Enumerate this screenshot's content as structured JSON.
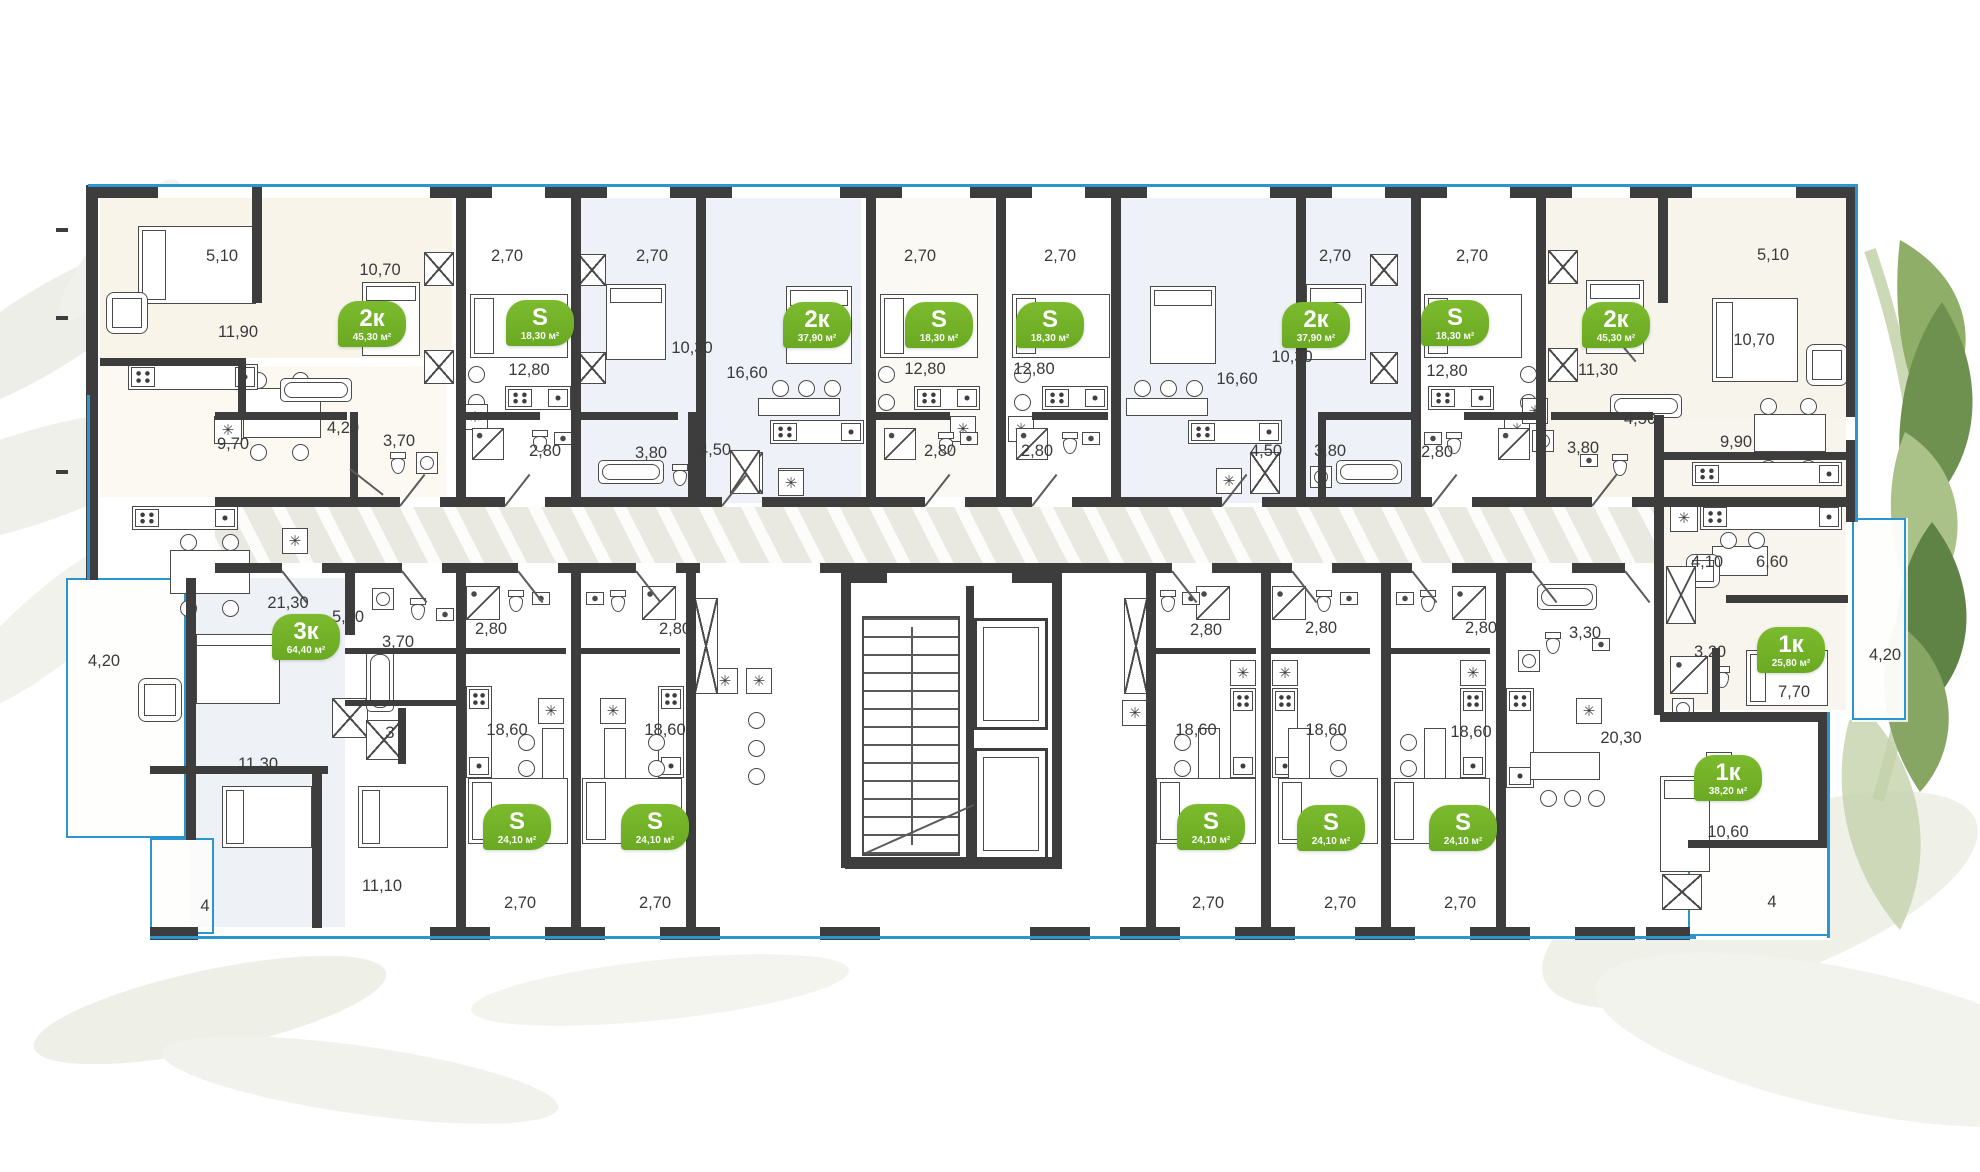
{
  "app": {
    "view": "residential-floor-plan"
  },
  "palette": {
    "wall": "#3d3d3d",
    "accent_green": "#74b228",
    "outline_blue": "#2a95d0",
    "corridor": "#e9e9e2",
    "room_cream": "#f8f4ea",
    "room_blue": "#eef1f7"
  },
  "units": [
    {
      "id": "u1",
      "type": "2к",
      "area": "45,30 м²",
      "badge": {
        "x": 372,
        "y": 324
      },
      "dims": [
        {
          "t": "5,10",
          "x": 222,
          "y": 256
        },
        {
          "t": "11,90",
          "x": 238,
          "y": 332
        },
        {
          "t": "10,70",
          "x": 380,
          "y": 270
        },
        {
          "t": "9,70",
          "x": 233,
          "y": 444
        },
        {
          "t": "4,20",
          "x": 343,
          "y": 428
        },
        {
          "t": "3,70",
          "x": 399,
          "y": 441
        }
      ]
    },
    {
      "id": "u2",
      "type": "S",
      "area": "18,30 м²",
      "badge": {
        "x": 540,
        "y": 323
      },
      "dims": [
        {
          "t": "2,70",
          "x": 507,
          "y": 256
        },
        {
          "t": "12,80",
          "x": 529,
          "y": 370
        },
        {
          "t": "2,80",
          "x": 545,
          "y": 451
        }
      ]
    },
    {
      "id": "u3",
      "type": "2к",
      "area": "37,90 м²",
      "badge": {
        "x": 817,
        "y": 325
      },
      "dims": [
        {
          "t": "2,70",
          "x": 652,
          "y": 256
        },
        {
          "t": "10,30",
          "x": 692,
          "y": 348
        },
        {
          "t": "16,60",
          "x": 747,
          "y": 373
        },
        {
          "t": "4,50",
          "x": 715,
          "y": 450
        },
        {
          "t": "3,80",
          "x": 651,
          "y": 453
        }
      ]
    },
    {
      "id": "u4",
      "type": "S",
      "area": "18,30 м²",
      "badge": {
        "x": 939,
        "y": 325
      },
      "dims": [
        {
          "t": "2,70",
          "x": 920,
          "y": 256
        },
        {
          "t": "12,80",
          "x": 925,
          "y": 369
        },
        {
          "t": "2,80",
          "x": 940,
          "y": 451
        }
      ]
    },
    {
      "id": "u5",
      "type": "S",
      "area": "18,30 м²",
      "badge": {
        "x": 1050,
        "y": 325
      },
      "dims": [
        {
          "t": "2,70",
          "x": 1060,
          "y": 256
        },
        {
          "t": "12,80",
          "x": 1034,
          "y": 369
        },
        {
          "t": "2,80",
          "x": 1037,
          "y": 451
        }
      ]
    },
    {
      "id": "u6",
      "type": "2к",
      "area": "37,90 м²",
      "badge": {
        "x": 1316,
        "y": 325
      },
      "dims": [
        {
          "t": "2,70",
          "x": 1335,
          "y": 256
        },
        {
          "t": "10,30",
          "x": 1292,
          "y": 357
        },
        {
          "t": "16,60",
          "x": 1237,
          "y": 379
        },
        {
          "t": "4,50",
          "x": 1266,
          "y": 451
        },
        {
          "t": "3,80",
          "x": 1330,
          "y": 451
        }
      ]
    },
    {
      "id": "u7",
      "type": "S",
      "area": "18,30 м²",
      "badge": {
        "x": 1455,
        "y": 323
      },
      "dims": [
        {
          "t": "2,70",
          "x": 1472,
          "y": 256
        },
        {
          "t": "12,80",
          "x": 1447,
          "y": 371
        },
        {
          "t": "2,80",
          "x": 1437,
          "y": 452
        }
      ]
    },
    {
      "id": "u8",
      "type": "2к",
      "area": "45,30 м²",
      "badge": {
        "x": 1616,
        "y": 325
      },
      "dims": [
        {
          "t": "5,10",
          "x": 1773,
          "y": 255
        },
        {
          "t": "10,70",
          "x": 1754,
          "y": 340
        },
        {
          "t": "11,30",
          "x": 1598,
          "y": 370
        },
        {
          "t": "4,50",
          "x": 1640,
          "y": 419
        },
        {
          "t": "9,90",
          "x": 1736,
          "y": 442
        },
        {
          "t": "3,80",
          "x": 1583,
          "y": 448
        }
      ]
    },
    {
      "id": "u9",
      "type": "3к",
      "area": "64,40 м²",
      "badge": {
        "x": 306,
        "y": 637
      },
      "dims": [
        {
          "t": "21,30",
          "x": 288,
          "y": 603
        },
        {
          "t": "5,80",
          "x": 348,
          "y": 617
        },
        {
          "t": "4,20",
          "x": 104,
          "y": 661
        },
        {
          "t": "3,70",
          "x": 398,
          "y": 642
        },
        {
          "t": "3",
          "x": 390,
          "y": 733
        },
        {
          "t": "11,30",
          "x": 258,
          "y": 764
        },
        {
          "t": "11,10",
          "x": 382,
          "y": 886
        },
        {
          "t": "4",
          "x": 205,
          "y": 906
        }
      ]
    },
    {
      "id": "s1",
      "type": "S",
      "area": "24,10 м²",
      "badge": {
        "x": 517,
        "y": 827
      },
      "dims": [
        {
          "t": "2,80",
          "x": 491,
          "y": 629
        },
        {
          "t": "18,60",
          "x": 507,
          "y": 730
        },
        {
          "t": "2,70",
          "x": 520,
          "y": 903
        }
      ]
    },
    {
      "id": "s2",
      "type": "S",
      "area": "24,10 м²",
      "badge": {
        "x": 655,
        "y": 827
      },
      "dims": [
        {
          "t": "2,80",
          "x": 675,
          "y": 629
        },
        {
          "t": "18,60",
          "x": 665,
          "y": 730
        },
        {
          "t": "2,70",
          "x": 655,
          "y": 903
        }
      ]
    },
    {
      "id": "s3",
      "type": "S",
      "area": "24,10 м²",
      "badge": {
        "x": 1211,
        "y": 827
      },
      "dims": [
        {
          "t": "2,80",
          "x": 1206,
          "y": 630
        },
        {
          "t": "18,60",
          "x": 1196,
          "y": 730
        },
        {
          "t": "2,70",
          "x": 1208,
          "y": 903
        }
      ]
    },
    {
      "id": "s4",
      "type": "S",
      "area": "24,10 м²",
      "badge": {
        "x": 1331,
        "y": 828
      },
      "dims": [
        {
          "t": "2,80",
          "x": 1321,
          "y": 628
        },
        {
          "t": "18,60",
          "x": 1326,
          "y": 730
        },
        {
          "t": "2,70",
          "x": 1340,
          "y": 903
        }
      ]
    },
    {
      "id": "s5",
      "type": "S",
      "area": "24,10 м²",
      "badge": {
        "x": 1463,
        "y": 828
      },
      "dims": [
        {
          "t": "2,80",
          "x": 1481,
          "y": 628
        },
        {
          "t": "18,60",
          "x": 1471,
          "y": 732
        },
        {
          "t": "2,70",
          "x": 1460,
          "y": 903
        }
      ]
    },
    {
      "id": "u16",
      "type": "1к",
      "area": "38,20 м²",
      "badge": {
        "x": 1728,
        "y": 778
      },
      "dims": [
        {
          "t": "20,30",
          "x": 1621,
          "y": 738
        },
        {
          "t": "10,60",
          "x": 1728,
          "y": 832
        },
        {
          "t": "3,30",
          "x": 1585,
          "y": 633
        },
        {
          "t": "4",
          "x": 1772,
          "y": 902
        }
      ]
    },
    {
      "id": "u17",
      "type": "1к",
      "area": "25,80 м²",
      "badge": {
        "x": 1791,
        "y": 650
      },
      "dims": [
        {
          "t": "4,10",
          "x": 1707,
          "y": 562
        },
        {
          "t": "6,60",
          "x": 1772,
          "y": 562
        },
        {
          "t": "3,20",
          "x": 1710,
          "y": 652
        },
        {
          "t": "7,70",
          "x": 1794,
          "y": 692
        },
        {
          "t": "4,20",
          "x": 1885,
          "y": 655
        }
      ]
    }
  ]
}
